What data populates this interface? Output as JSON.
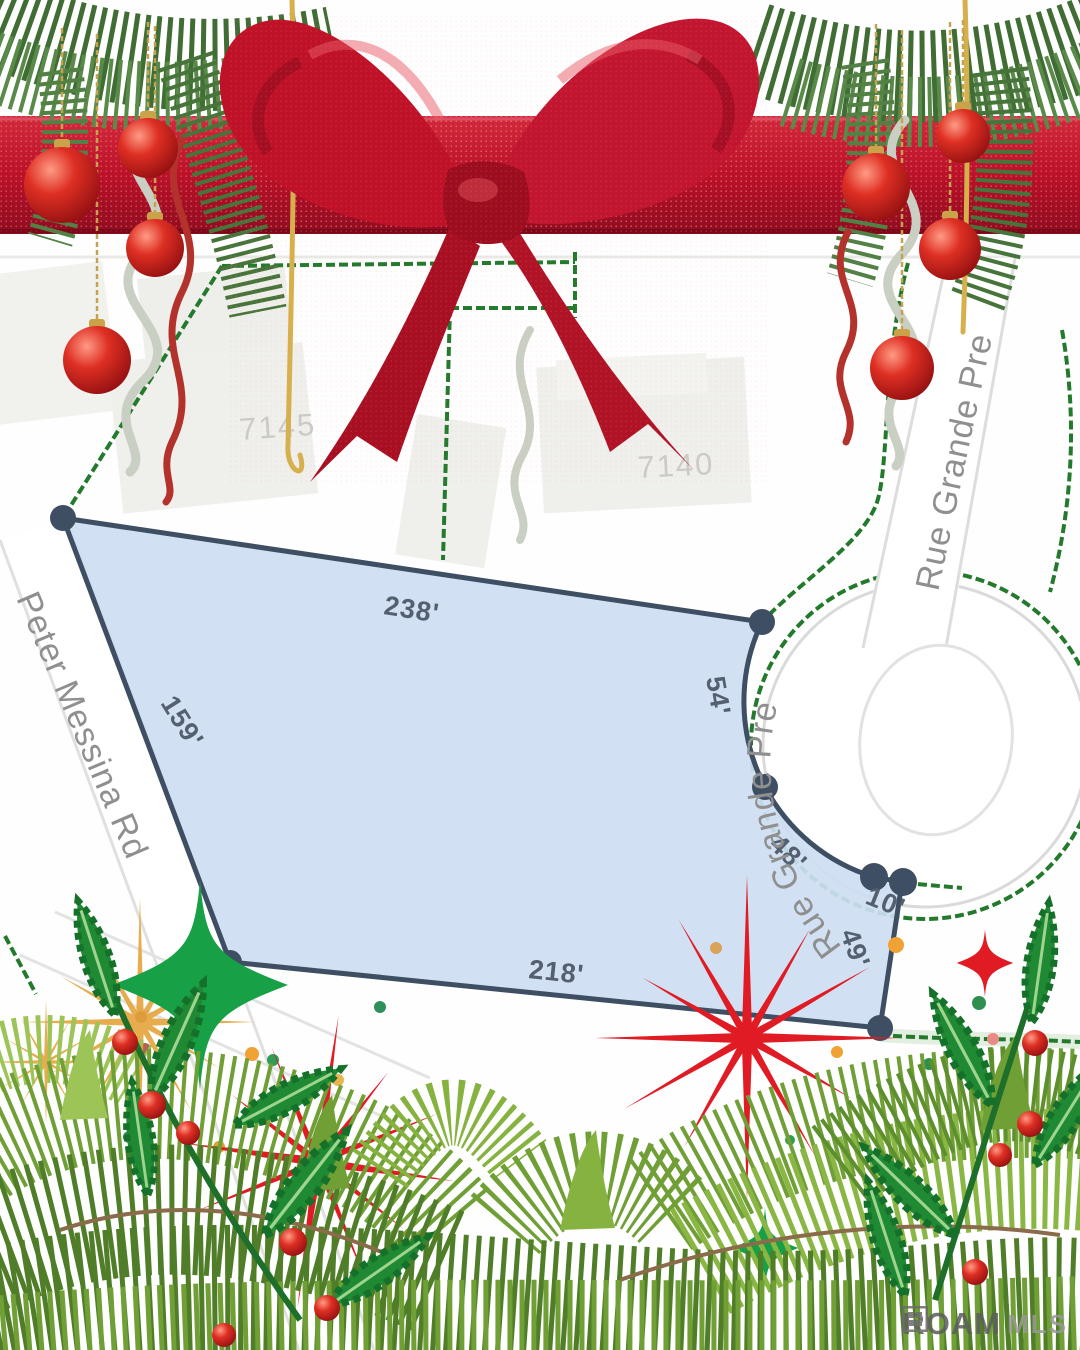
{
  "map": {
    "streets": [
      {
        "id": "peter-messina-rd",
        "label": "Peter Messina Rd"
      },
      {
        "id": "rue-grande-pre-vertical",
        "label": "Rue Grande Pre"
      },
      {
        "id": "rue-grande-pre-curved",
        "label": "Rue Grande Pre"
      }
    ],
    "houses": [
      {
        "number": "7145"
      },
      {
        "number": "7140"
      }
    ],
    "lot": {
      "fill_color": "#cddef2",
      "stroke_color": "#3e4e63",
      "dimensions": [
        {
          "side": "top",
          "label": "238'"
        },
        {
          "side": "left",
          "label": "159'"
        },
        {
          "side": "upper-right-curve",
          "label": "54'"
        },
        {
          "side": "lower-right-curve",
          "label": "48'"
        },
        {
          "side": "notch",
          "label": "10'"
        },
        {
          "side": "right",
          "label": "49'"
        },
        {
          "side": "bottom",
          "label": "218'"
        }
      ]
    },
    "boundary_line_color": "#237a2d",
    "road_edge_color": "#dcdcdc",
    "street_label_color": "#8f8f8f",
    "dimension_color": "#54606f",
    "house_number_color": "#cbcbc6"
  },
  "watermark": {
    "brand": "ROAM",
    "suffix": "MLS"
  },
  "decorations": {
    "ribbon_red": "#b5122a",
    "bow_red": "#bf1228",
    "ornament_red": "#c41a1a",
    "pine_dark": "#3f6d33",
    "pine_light": "#8ab744",
    "holly_green": "#1f8a33",
    "berry_red": "#d92121",
    "sparkle_green": "#17a046",
    "sparkle_red": "#e01b24",
    "sparkle_gold": "#e5a43c",
    "curl_silver": "#c9cfc2",
    "curl_gold": "#d7b04e"
  }
}
